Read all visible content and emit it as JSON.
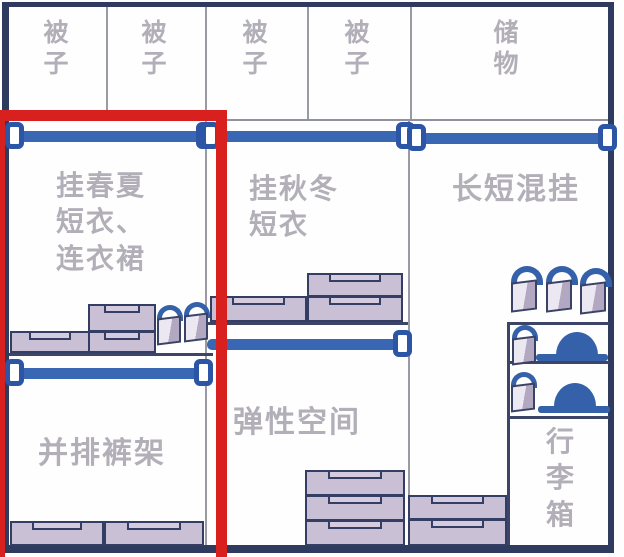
{
  "diagram": {
    "type": "wardrobe-storage-layout",
    "colors": {
      "highlight_red": "#d8201f",
      "rod_blue": "#3a67b3",
      "bracket_blue": "#2c55a5",
      "accent_blue": "#3560aa",
      "frame_navy": "#2e3a5e",
      "box_fill": "#cac0d6",
      "label_gray": "#b2afb8"
    }
  },
  "top_row": {
    "compartments": [
      {
        "label": "被子"
      },
      {
        "label": "被子"
      },
      {
        "label": "被子"
      },
      {
        "label": "被子"
      },
      {
        "label": "储物"
      }
    ]
  },
  "sections": {
    "left": {
      "highlighted": true,
      "hang_label_lines": [
        "挂春夏",
        "短衣、",
        "连衣裙"
      ],
      "bottom_label": "并排裤架",
      "items": {
        "hanging_rods": 2,
        "storage_boxes": 3,
        "handbags": 2,
        "bottom_drawers": 2
      }
    },
    "middle": {
      "highlighted": false,
      "hang_label_lines": [
        "挂秋冬",
        "短衣"
      ],
      "bottom_label": "弹性空间",
      "items": {
        "hanging_rods": 2,
        "storage_boxes": 3,
        "bottom_drawers": 3
      }
    },
    "right": {
      "highlighted": false,
      "hang_label": "长短混挂",
      "bottom_label": "行李箱",
      "items": {
        "hanging_rods": 1,
        "shelf_levels": 3,
        "handbags": 5,
        "hats": 2,
        "bottom_drawers": 2
      }
    }
  }
}
